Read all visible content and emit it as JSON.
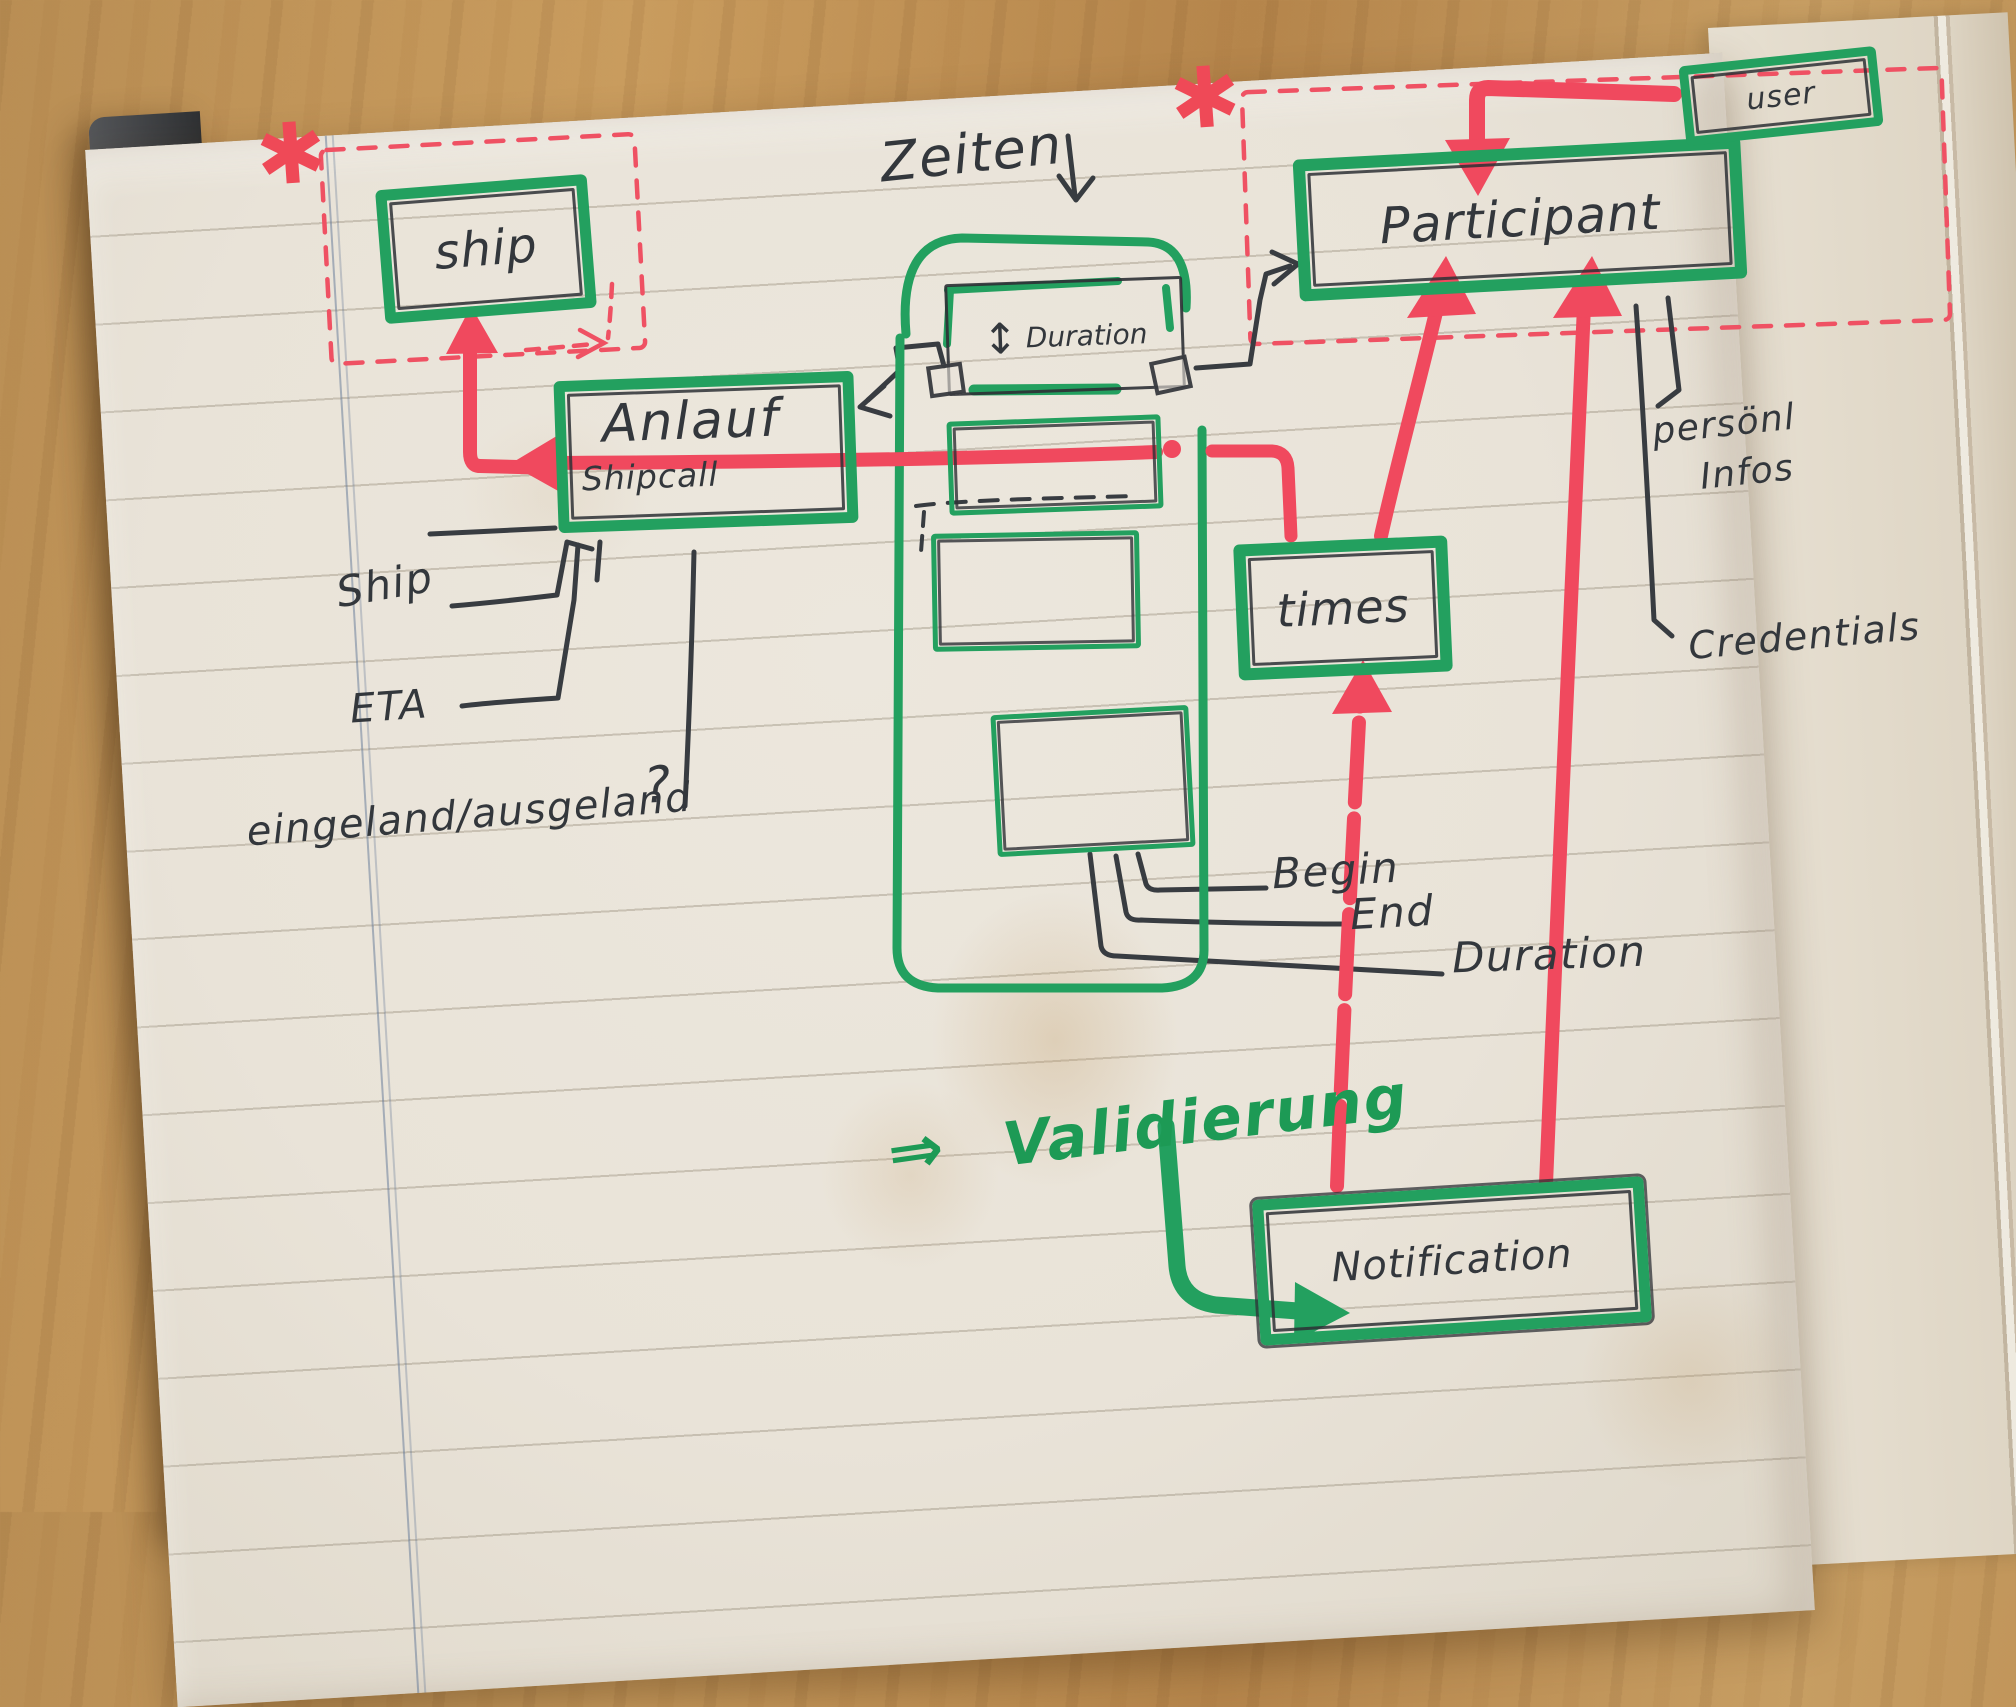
{
  "scene": {
    "description": "hand-drawn data model sketch on lined notebook page",
    "marker_green": "#23a05f",
    "marker_red": "#f0495e",
    "ink": "#33373c",
    "paper": "#e9e3d8"
  },
  "boxes": {
    "ship": {
      "label": "ship"
    },
    "anlauf": {
      "label": "Anlauf",
      "sublabel": "Shipcall"
    },
    "participant": {
      "label": "Participant"
    },
    "user": {
      "label": "user"
    },
    "times": {
      "label": "times"
    },
    "notification": {
      "label": "Notification"
    },
    "duration": {
      "label": "Duration",
      "arrow_glyph": "↕"
    }
  },
  "labels": {
    "zeiten": "Zeiten",
    "ship_attr": "Ship",
    "eta": "ETA",
    "ein_aus": "eingeland/ausgeland",
    "question": "?",
    "begin": "Begin",
    "end": "End",
    "duration": "Duration",
    "persoenl_line1": "persönl",
    "persoenl_line2": "Infos",
    "credentials": "Credentials",
    "validierung_arrow": "⇒",
    "validierung": "Validierung",
    "asterisk_left": "✱",
    "asterisk_right": "✱"
  }
}
